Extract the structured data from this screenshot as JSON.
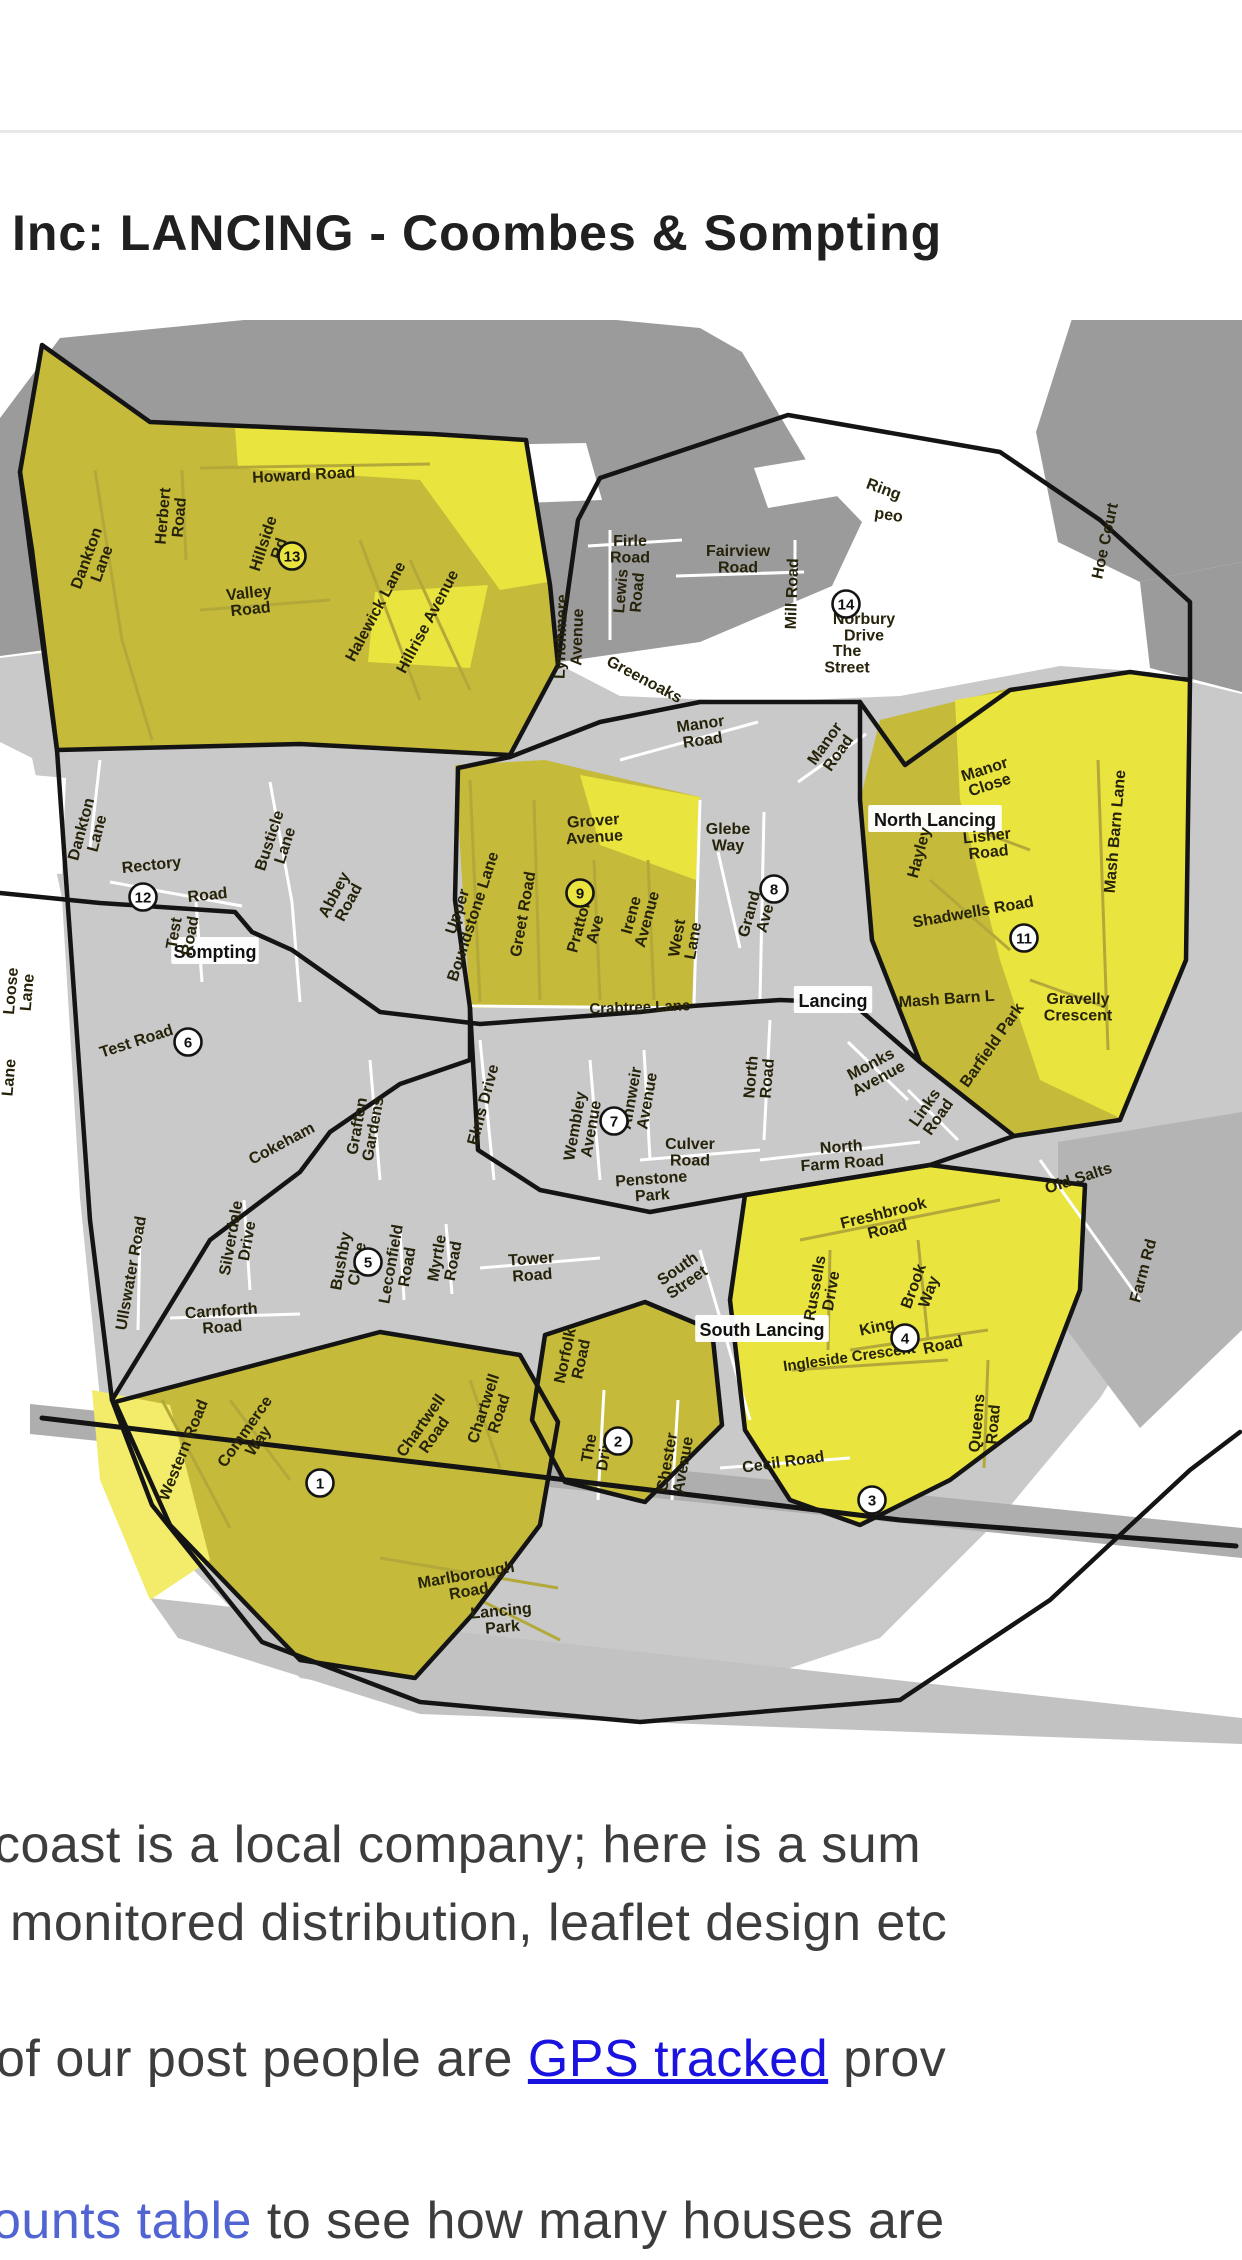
{
  "header": {
    "title": "Inc: LANCING - Coombes & Sompting"
  },
  "paragraphs": {
    "p1_line1": "coast is a local company;  here is a sum",
    "p1_line2": "monitored distribution, leaflet design etc",
    "p2_before": "of our post people are ",
    "p2_link": "GPS tracked",
    "p2_after": " prov",
    "p3_link": "ounts table",
    "p3_after": " to see how many houses are"
  },
  "map": {
    "colors": {
      "zone_olive": "#c5ba3a",
      "zone_bright": "#eae43e",
      "zone_pale": "#f2ec6a",
      "land_dark": "#9b9b9b",
      "land_light": "#c9c9c9",
      "border": "#141414",
      "link_blue": "#1a12e0",
      "link_blue_light": "#5064d2",
      "text_dark": "#3d3d3d"
    },
    "boxes": [
      {
        "t": "Sompting",
        "x": 215,
        "y": 952
      },
      {
        "t": "Lancing",
        "x": 833,
        "y": 1001
      },
      {
        "t": "North Lancing",
        "x": 935,
        "y": 820
      },
      {
        "t": "South Lancing",
        "x": 762,
        "y": 1330
      }
    ],
    "labels": [
      {
        "t": "Howard Road",
        "x": 304,
        "y": 480,
        "r": -3
      },
      {
        "t": "Herbert\nRoad",
        "x": 174,
        "y": 517,
        "r": -85
      },
      {
        "t": "Hillside\nRd",
        "x": 274,
        "y": 547,
        "r": -72
      },
      {
        "t": "Dankton\nLane",
        "x": 97,
        "y": 562,
        "r": -70
      },
      {
        "t": "Valley\nRoad",
        "x": 250,
        "y": 604,
        "r": -6
      },
      {
        "t": "Halewick Lane",
        "x": 380,
        "y": 614,
        "r": -62
      },
      {
        "t": "Hillrise Avenue",
        "x": 432,
        "y": 624,
        "r": -62
      },
      {
        "t": "Lynchmere\nAvenue",
        "x": 572,
        "y": 637,
        "r": -88
      },
      {
        "t": "Lewis\nRoad",
        "x": 632,
        "y": 592,
        "r": -85
      },
      {
        "t": "Firle\nRoad",
        "x": 630,
        "y": 552,
        "r": 0
      },
      {
        "t": "Fairview\nRoad",
        "x": 738,
        "y": 562,
        "r": 0
      },
      {
        "t": "Mill Road",
        "x": 797,
        "y": 594,
        "r": -88
      },
      {
        "t": "Ring",
        "x": 882,
        "y": 494,
        "r": 20
      },
      {
        "t": "peo",
        "x": 888,
        "y": 520,
        "r": 8
      },
      {
        "t": "Norbury\nDrive",
        "x": 864,
        "y": 630,
        "r": 0
      },
      {
        "t": "The\nStreet",
        "x": 847,
        "y": 662,
        "r": 0
      },
      {
        "t": "Hoe Court",
        "x": 1110,
        "y": 542,
        "r": -78
      },
      {
        "t": "Greenoaks",
        "x": 642,
        "y": 684,
        "r": 28
      },
      {
        "t": "Manor\nRoad",
        "x": 702,
        "y": 735,
        "r": -8
      },
      {
        "t": "Manor\nRoad",
        "x": 834,
        "y": 750,
        "r": -55
      },
      {
        "t": "Manor\nClose",
        "x": 988,
        "y": 780,
        "r": -18
      },
      {
        "t": "Lisher\nRoad",
        "x": 988,
        "y": 847,
        "r": -6
      },
      {
        "t": "Hayley",
        "x": 924,
        "y": 854,
        "r": -75
      },
      {
        "t": "Shadwells Road",
        "x": 974,
        "y": 917,
        "r": -10
      },
      {
        "t": "Mash Barn Lane",
        "x": 1120,
        "y": 832,
        "r": -85
      },
      {
        "t": "Gravelly\nCrescent",
        "x": 1078,
        "y": 1010,
        "r": 0
      },
      {
        "t": "Barfield Park",
        "x": 996,
        "y": 1048,
        "r": -55
      },
      {
        "t": "Mash Barn L",
        "x": 947,
        "y": 1004,
        "r": -4
      },
      {
        "t": "Monks\nAvenue",
        "x": 876,
        "y": 1074,
        "r": -28
      },
      {
        "t": "Links\nRoad",
        "x": 934,
        "y": 1114,
        "r": -55
      },
      {
        "t": "North\nRoad",
        "x": 762,
        "y": 1078,
        "r": -85
      },
      {
        "t": "North\nFarm Road",
        "x": 842,
        "y": 1158,
        "r": -4
      },
      {
        "t": "Grover\nAvenue",
        "x": 594,
        "y": 832,
        "r": -4
      },
      {
        "t": "Glebe\nWay",
        "x": 728,
        "y": 840,
        "r": 0
      },
      {
        "t": "Grand\nAve",
        "x": 760,
        "y": 917,
        "r": -75
      },
      {
        "t": "Upper\nBoundstone Lane",
        "x": 468,
        "y": 915,
        "r": -72
      },
      {
        "t": "Greet Road",
        "x": 528,
        "y": 915,
        "r": -80
      },
      {
        "t": "Pratton\nAve",
        "x": 590,
        "y": 928,
        "r": -75
      },
      {
        "t": "Irene\nAvenue",
        "x": 642,
        "y": 918,
        "r": -75
      },
      {
        "t": "West\nLane",
        "x": 688,
        "y": 940,
        "r": -80
      },
      {
        "t": "Crabtree Lane",
        "x": 640,
        "y": 1012,
        "r": -2,
        "s": 15
      },
      {
        "t": "Rectory",
        "x": 152,
        "y": 870,
        "r": -6
      },
      {
        "t": "Road",
        "x": 208,
        "y": 900,
        "r": -6
      },
      {
        "t": "Busticle\nLane",
        "x": 280,
        "y": 844,
        "r": -72
      },
      {
        "t": "Abbey\nRoad",
        "x": 344,
        "y": 900,
        "r": -62
      },
      {
        "t": "Dankton\nLane",
        "x": 92,
        "y": 832,
        "r": -75
      },
      {
        "t": "Loose\nLane",
        "x": 22,
        "y": 992,
        "r": -85
      },
      {
        "t": "Lane",
        "x": 14,
        "y": 1078,
        "r": -85
      },
      {
        "t": "Test\nRoad",
        "x": 185,
        "y": 935,
        "r": -80
      },
      {
        "t": "Test Road",
        "x": 138,
        "y": 1046,
        "r": -18
      },
      {
        "t": "Wembley\nAvenue",
        "x": 586,
        "y": 1128,
        "r": -80
      },
      {
        "t": "Annweir\nAvenue",
        "x": 642,
        "y": 1100,
        "r": -80
      },
      {
        "t": "Culver\nRoad",
        "x": 690,
        "y": 1155,
        "r": 0
      },
      {
        "t": "Penstone\nPark",
        "x": 652,
        "y": 1190,
        "r": -4
      },
      {
        "t": "Elms Drive",
        "x": 488,
        "y": 1106,
        "r": -75
      },
      {
        "t": "Grafton\nGardens",
        "x": 368,
        "y": 1128,
        "r": -80
      },
      {
        "t": "Cokeham",
        "x": 284,
        "y": 1148,
        "r": -28
      },
      {
        "t": "Silverdale\nDrive",
        "x": 242,
        "y": 1240,
        "r": -80
      },
      {
        "t": "Ullswater Road",
        "x": 136,
        "y": 1274,
        "r": -80
      },
      {
        "t": "Bushby\nClose",
        "x": 352,
        "y": 1263,
        "r": -80
      },
      {
        "t": "Leconfield\nRoad",
        "x": 402,
        "y": 1266,
        "r": -80
      },
      {
        "t": "Myrtle\nRoad",
        "x": 448,
        "y": 1260,
        "r": -80
      },
      {
        "t": "Tower\nRoad",
        "x": 532,
        "y": 1270,
        "r": -4
      },
      {
        "t": "Carnforth\nRoad",
        "x": 222,
        "y": 1322,
        "r": -4
      },
      {
        "t": "South\nStreet",
        "x": 684,
        "y": 1278,
        "r": -35
      },
      {
        "t": "Freshbrook\nRoad",
        "x": 886,
        "y": 1224,
        "r": -14
      },
      {
        "t": "Russells\nDrive",
        "x": 826,
        "y": 1290,
        "r": -80
      },
      {
        "t": "Brook\nWay",
        "x": 924,
        "y": 1290,
        "r": -70
      },
      {
        "t": "King",
        "x": 878,
        "y": 1332,
        "r": -12
      },
      {
        "t": "Road",
        "x": 944,
        "y": 1350,
        "r": -12
      },
      {
        "t": "Ingleside Crescent",
        "x": 850,
        "y": 1362,
        "r": -8,
        "s": 15
      },
      {
        "t": "Old Salts",
        "x": 1080,
        "y": 1183,
        "r": -18
      },
      {
        "t": "Farm Rd",
        "x": 1148,
        "y": 1272,
        "r": -75
      },
      {
        "t": "Queens\nRoad",
        "x": 988,
        "y": 1424,
        "r": -85
      },
      {
        "t": "Cecil Road",
        "x": 784,
        "y": 1467,
        "r": -8
      },
      {
        "t": "Chester\nAvenue",
        "x": 678,
        "y": 1464,
        "r": -80
      },
      {
        "t": "The\nDrive",
        "x": 600,
        "y": 1450,
        "r": -80
      },
      {
        "t": "Norfolk\nRoad",
        "x": 576,
        "y": 1358,
        "r": -78
      },
      {
        "t": "Chartwell\nRoad",
        "x": 494,
        "y": 1412,
        "r": -72
      },
      {
        "t": "Chartwell\nRoad",
        "x": 430,
        "y": 1432,
        "r": -55
      },
      {
        "t": "Commerce\nWay",
        "x": 254,
        "y": 1438,
        "r": -55
      },
      {
        "t": "Western Road",
        "x": 188,
        "y": 1452,
        "r": -68
      },
      {
        "t": "Marlborough\nRoad",
        "x": 468,
        "y": 1586,
        "r": -10
      },
      {
        "t": "Lancing\nPark",
        "x": 502,
        "y": 1622,
        "r": -5
      }
    ],
    "markers": [
      {
        "n": "1",
        "x": 320,
        "y": 1483
      },
      {
        "n": "2",
        "x": 618,
        "y": 1441
      },
      {
        "n": "3",
        "x": 872,
        "y": 1500
      },
      {
        "n": "4",
        "x": 905,
        "y": 1338
      },
      {
        "n": "5",
        "x": 368,
        "y": 1262
      },
      {
        "n": "6",
        "x": 188,
        "y": 1042
      },
      {
        "n": "7",
        "x": 614,
        "y": 1121
      },
      {
        "n": "8",
        "x": 774,
        "y": 889
      },
      {
        "n": "9",
        "x": 580,
        "y": 893,
        "f": "#eae43e"
      },
      {
        "n": "11",
        "x": 1024,
        "y": 938
      },
      {
        "n": "12",
        "x": 143,
        "y": 897
      },
      {
        "n": "13",
        "x": 292,
        "y": 556,
        "f": "#eae43e"
      },
      {
        "n": "14",
        "x": 846,
        "y": 604
      }
    ]
  }
}
